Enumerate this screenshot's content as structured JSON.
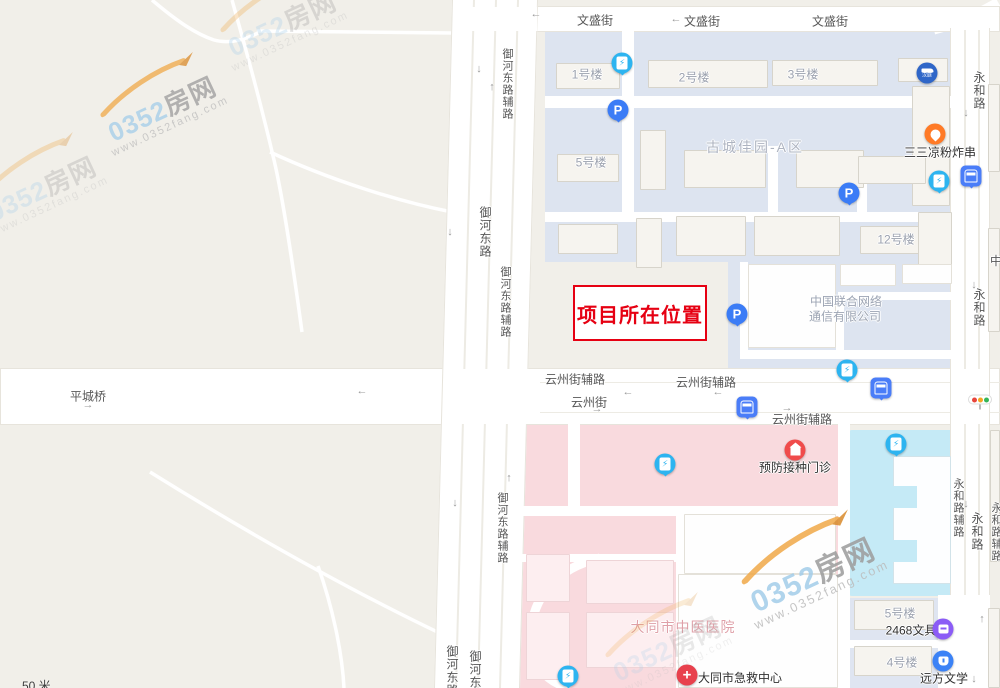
{
  "map": {
    "scale_label": "50 米",
    "watermark": {
      "brand_number": "0352",
      "brand_name": "房网",
      "url": "www.0352fang.com"
    },
    "highlight": {
      "label": "项目所在位置",
      "color": "#e60012"
    },
    "arrows": {
      "left": "←",
      "right": "→",
      "up": "↑",
      "down": "↓"
    },
    "roads": {
      "wensheng": "文盛街",
      "yuhe_aux": "御河东路辅路",
      "yuhe": "御河东路",
      "yunzhou_aux": "云州街辅路",
      "yunzhou": "云州街",
      "pingcheng_bridge": "平城桥",
      "yonghe": "永和路",
      "yonghe_aux": "永和路辅路",
      "partial_zhong": "中"
    },
    "places": {
      "community": "古城佳园-A区",
      "bldg1": "1号楼",
      "bldg2": "2号楼",
      "bldg3": "3号楼",
      "bldg5": "5号楼",
      "bldg12": "12号楼",
      "food": "三三凉粉炸串",
      "unicom_line1": "中国联合网络",
      "unicom_line2": "通信有限公司",
      "vaccine_clinic": "预防接种门诊",
      "tcm_hospital": "大同市中医医院",
      "emergency_center": "大同市急救中心",
      "stationery": "2468文具",
      "bldg5_south": "5号楼",
      "bldg4_south": "4号楼",
      "literature": "远方文学",
      "hotel": "汉庭"
    },
    "icons": {
      "parking": {
        "glyph": "P",
        "color": "#3b7cf6"
      },
      "charging": {
        "glyph": "⚡",
        "color": "#2db4f0"
      },
      "bus_stop": {
        "color": "#4a7df8"
      },
      "traffic_light": {
        "colors": [
          "#e8453c",
          "#f5a623",
          "#35b558"
        ]
      },
      "hotel": {
        "color": "#2f66c8"
      },
      "food": {
        "color": "#ff7a26"
      },
      "clinic": {
        "color": "#f04b4b"
      },
      "emergency": {
        "glyph": "+",
        "color": "#e8414d"
      },
      "stationery": {
        "color": "#8b5cf6"
      },
      "education": {
        "color": "#3b82f6"
      }
    },
    "region_colors": {
      "land": "#f1efe9",
      "residential": "#dde4f0",
      "hospital": "#f9dade",
      "school_cyan": "#c5eaf6",
      "road": "#ffffff"
    }
  }
}
